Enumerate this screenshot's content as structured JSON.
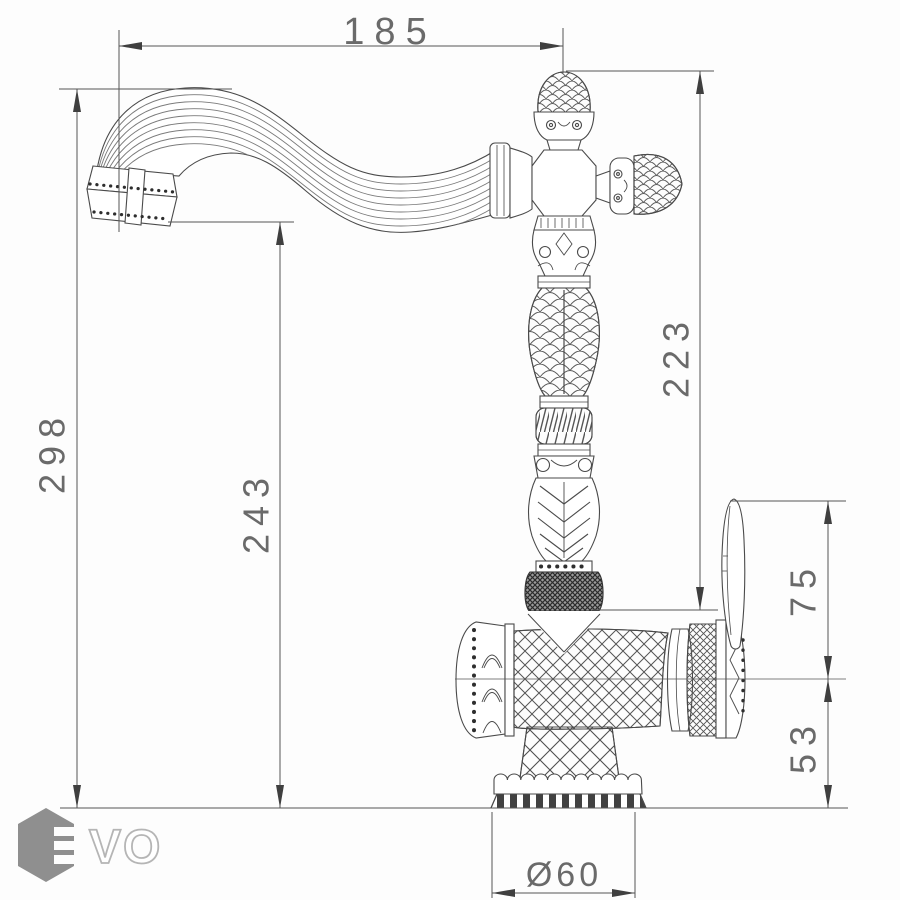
{
  "colors": {
    "line": "#4f4f4f",
    "dim_line": "#555555",
    "text": "#6a6a6a",
    "logo_hex": "#8f8f8f",
    "logo_outline": "#b5b5b5",
    "background": "#fdfdfd"
  },
  "dimensions": {
    "spout_reach": "185",
    "overall_height": "298",
    "spout_outlet_height": "243",
    "column_height": "223",
    "handle_height": "75",
    "body_height": "53",
    "base_diameter": "Ø60"
  },
  "logo": {
    "brand": "EVO",
    "text_vo": "VO"
  }
}
